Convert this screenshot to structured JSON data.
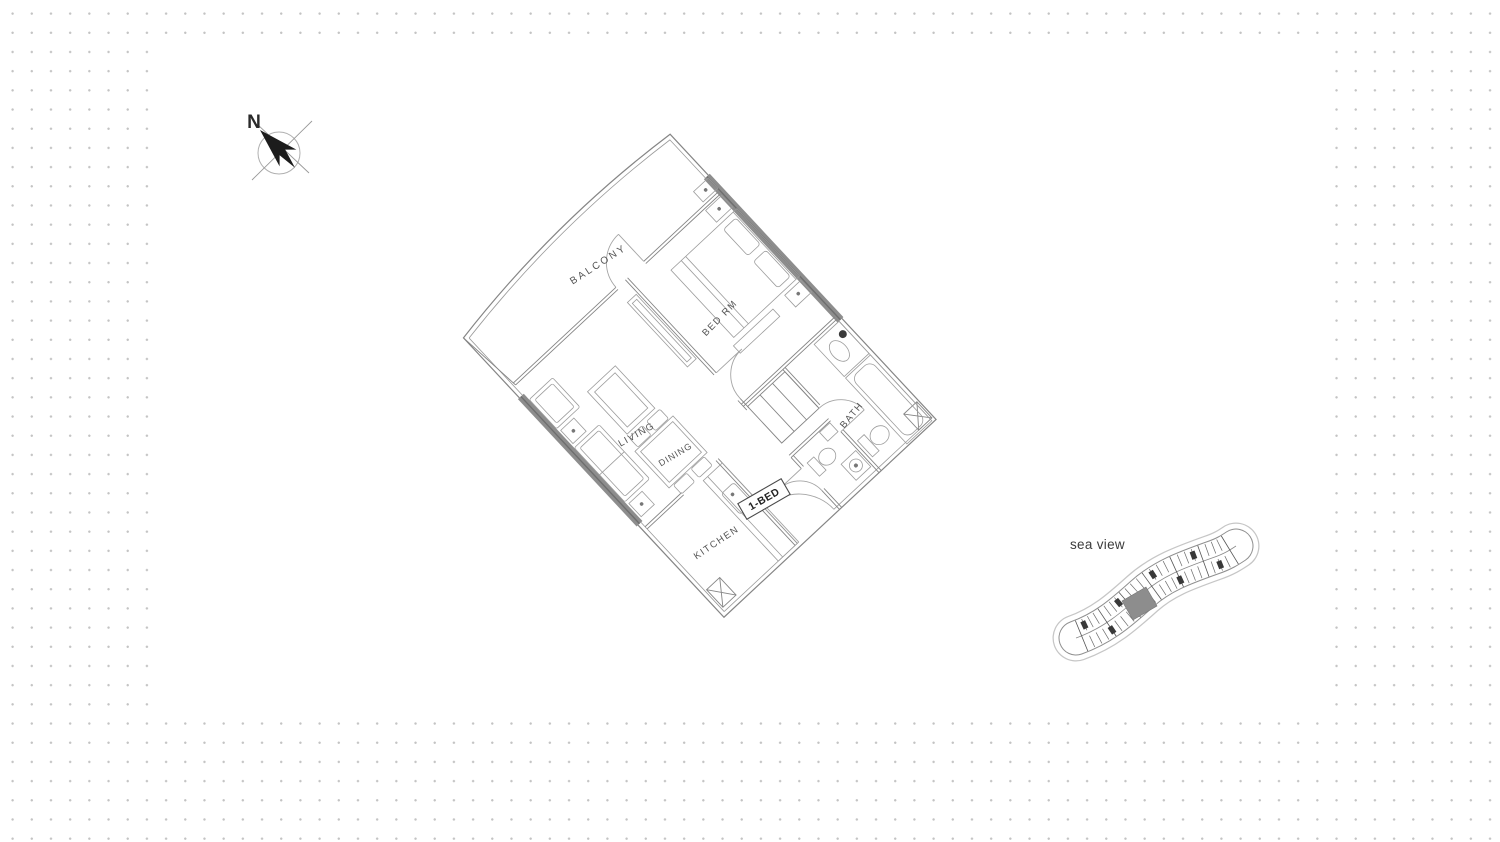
{
  "compass": {
    "label": "N"
  },
  "floor_plan": {
    "rooms": [
      {
        "name": "balcony",
        "label": "BALCONY"
      },
      {
        "name": "bedroom",
        "label": "BED RM"
      },
      {
        "name": "living",
        "label": "LIVING"
      },
      {
        "name": "dining",
        "label": "DINING"
      },
      {
        "name": "kitchen",
        "label": "KITCHEN"
      },
      {
        "name": "bath",
        "label": "BATH"
      }
    ],
    "unit_type_label": "1-BED"
  },
  "key_plan": {
    "caption": "sea view"
  },
  "colors": {
    "dots": "#c3c3c3",
    "panel": "#ffffff",
    "wall": "#858585",
    "glazing": "#8d8d8d",
    "highlight_unit": "#8d8d8d",
    "label_text": "#555555",
    "caption_text": "#3c3c3c"
  }
}
